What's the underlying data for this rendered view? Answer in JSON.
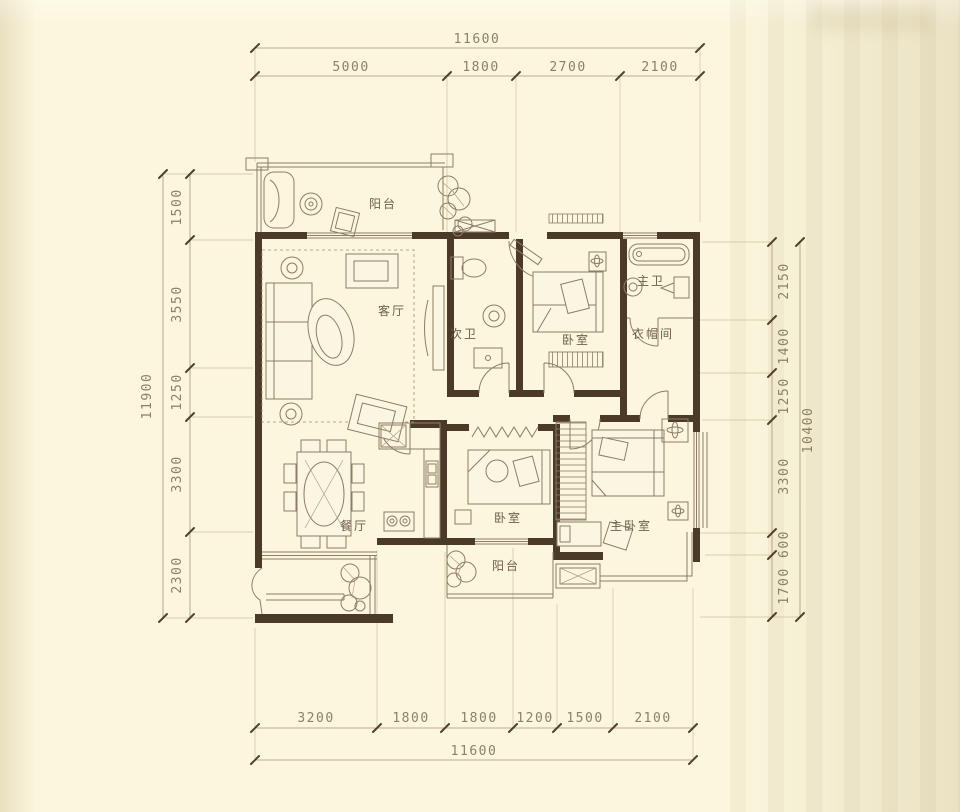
{
  "colors": {
    "background": "#fbf6dd",
    "wall": "#4c3a29",
    "line_work": "#8d7d66",
    "dimension_text": "#8c8166"
  },
  "rooms": {
    "balcony_top": "阳台",
    "living_room": "客厅",
    "second_bath": "次卫",
    "bedroom_top": "卧室",
    "master_bath": "主卫",
    "cloakroom": "衣帽间",
    "dining_room": "餐厅",
    "bedroom_bottom": "卧室",
    "balcony_bottom": "阳台",
    "master_bedroom": "主卧室"
  },
  "dimensions": {
    "top": {
      "total": "11600",
      "segments": [
        "5000",
        "1800",
        "2700",
        "2100"
      ]
    },
    "bottom": {
      "total": "11600",
      "segments": [
        "3200",
        "1800",
        "1800",
        "1200",
        "1500",
        "2100"
      ]
    },
    "left": {
      "total": "11900",
      "segments": [
        "1500",
        "3550",
        "1250",
        "3300",
        "2300"
      ]
    },
    "right": {
      "total": "10400",
      "segments": [
        "2150",
        "1400",
        "1250",
        "3300",
        "600",
        "1700"
      ]
    }
  }
}
